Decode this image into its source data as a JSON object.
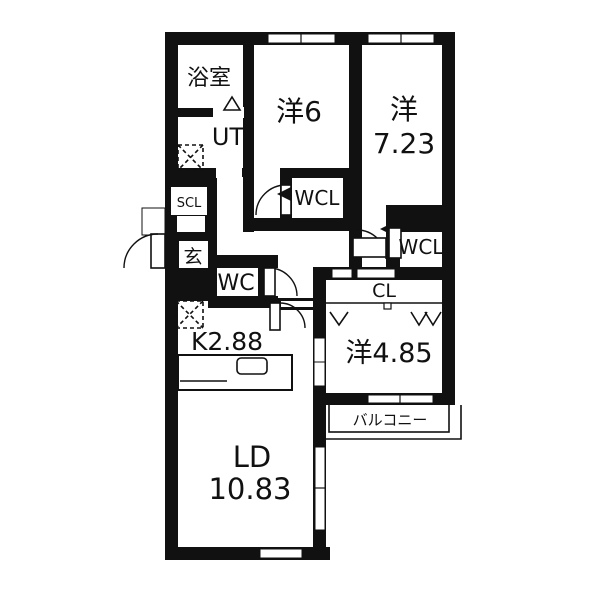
{
  "floorplan": {
    "colors": {
      "wall": "#111111",
      "floor": "#ffffff"
    },
    "rooms": {
      "bathroom": {
        "label": "浴室"
      },
      "utility": {
        "label": "UT"
      },
      "shoe_closet": {
        "label": "SCL"
      },
      "entrance": {
        "label": "玄"
      },
      "toilet": {
        "label": "WC"
      },
      "wcl_center": {
        "label": "WCL"
      },
      "wcl_right": {
        "label": "WCL"
      },
      "bedroom_6": {
        "label": "洋6"
      },
      "bedroom_723": {
        "label_line1": "洋",
        "label_line2": "7.23"
      },
      "closet": {
        "label": "CL"
      },
      "bedroom_485": {
        "label": "洋4.85"
      },
      "kitchen": {
        "label": "K2.88"
      },
      "living_dining": {
        "label_line1": "LD",
        "label_line2": "10.83"
      },
      "balcony": {
        "label": "バルコニー"
      }
    }
  }
}
